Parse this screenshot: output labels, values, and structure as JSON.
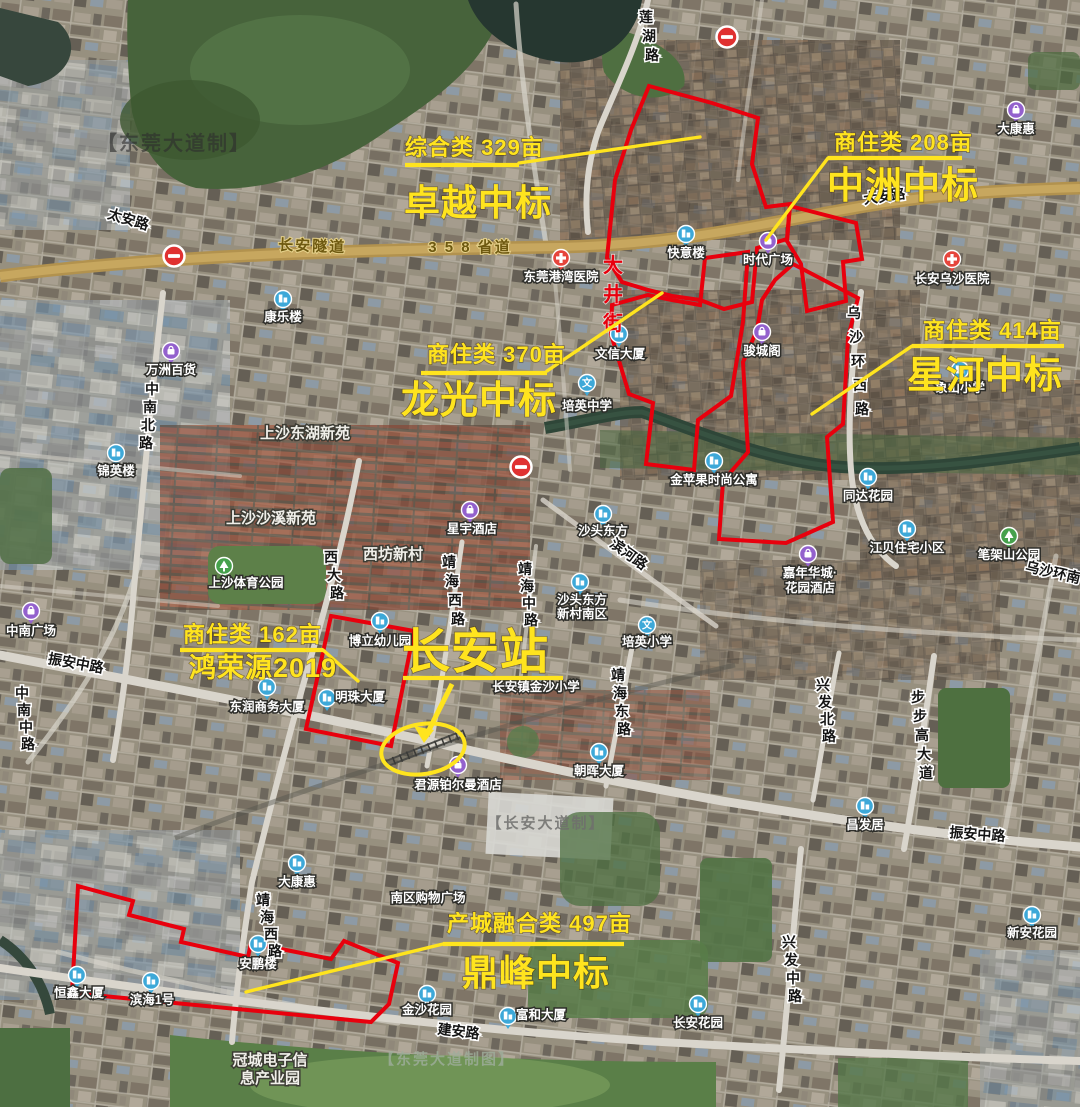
{
  "map": {
    "colors": {
      "annotation_yellow": "#ffe41e",
      "parcel_red": "#e8000d",
      "road_gold": "#b2924e"
    },
    "watermarks": [
      {
        "text": "【东莞大道制】",
        "x": 174,
        "y": 150,
        "size": 20,
        "fill": "#2e2e2e",
        "op": 0.62
      },
      {
        "text": "【长安大道制】",
        "x": 546,
        "y": 828,
        "size": 15,
        "fill": "#6f6f6d",
        "op": 0.85
      },
      {
        "text": "【东莞大道制图】",
        "x": 447,
        "y": 1064,
        "size": 15,
        "fill": "#9fae9c",
        "op": 0.8
      }
    ],
    "annotations": [
      {
        "id": "zhuoyue",
        "line1": "综合类 329亩",
        "line2": "卓越中标",
        "x1": 405,
        "y1": 155,
        "s1": 22,
        "x2": 404,
        "y2": 215,
        "s2": 36,
        "underline": [
          405,
          165,
          519,
          165
        ],
        "leader": "519,163 700,137"
      },
      {
        "id": "zhongzhou",
        "line1": "商住类 208亩",
        "line2": "中洲中标",
        "x1": 834,
        "y1": 150,
        "s1": 22,
        "x2": 827,
        "y2": 198,
        "s2": 37,
        "underline": [
          828,
          158,
          962,
          158
        ],
        "leader": "828,158 766,240"
      },
      {
        "id": "xinghe",
        "line1": "商住类 414亩",
        "line2": "星河中标",
        "x1": 923,
        "y1": 338,
        "s1": 22,
        "x2": 907,
        "y2": 388,
        "s2": 38,
        "underline": [
          912,
          346,
          1064,
          346
        ],
        "leader": "912,346 812,414"
      },
      {
        "id": "longguang",
        "line1": "商住类 370亩",
        "line2": "龙光中标",
        "x1": 427,
        "y1": 362,
        "s1": 22,
        "x2": 401,
        "y2": 413,
        "s2": 38,
        "underline": [
          421,
          373,
          547,
          373
        ],
        "leader": "547,371 662,293"
      },
      {
        "id": "hongrongyuan",
        "line1": "商住类 162亩",
        "line2": "鸿荣源2019",
        "x1": 183,
        "y1": 642,
        "s1": 22,
        "x2": 189,
        "y2": 677,
        "s2": 27,
        "underline": [
          180,
          650,
          323,
          650
        ],
        "leader": "323,650 358,681"
      },
      {
        "id": "dingfeng",
        "line1": "产城融合类 497亩",
        "line2": "鼎峰中标",
        "x1": 447,
        "y1": 931,
        "s1": 22,
        "x2": 462,
        "y2": 985,
        "s2": 36,
        "underline": [
          443,
          944,
          624,
          944
        ],
        "leader": "443,944 246,992"
      }
    ],
    "station": {
      "label": "长安站",
      "x": 402,
      "y": 668,
      "size": 48,
      "underline": [
        403,
        678,
        563,
        678
      ],
      "arrow_line": [
        452,
        684,
        427,
        734
      ],
      "arrow_head": "424,743 414,726 434,730",
      "ellipse": {
        "cx": 423,
        "cy": 749,
        "rx": 42,
        "ry": 25,
        "rot": -9
      }
    },
    "street_label": {
      "text": "大井街",
      "x": 613,
      "y": 272,
      "dy": 29
    },
    "parcels": [
      {
        "id": "zhuoyue",
        "points": "649,86 712,103 758,118 752,164 766,207 790,204 787,239 757,248 752,302 724,309 700,300 672,296 648,290 622,282 607,258 615,180 631,130"
      },
      {
        "id": "zhongzhou",
        "points": "790,206 856,223 862,259 843,262 846,301 807,311 801,264 787,241"
      },
      {
        "id": "longguang",
        "points": "612,305 648,295 672,300 700,305 705,258 748,252 743,322 731,396 698,420 694,470 646,464 653,403 629,394 611,334"
      },
      {
        "id": "xinghe",
        "points": "793,264 858,298 848,338 843,424 827,437 833,522 786,543 719,539 723,481 748,452 743,362 757,330 762,300 775,280"
      },
      {
        "id": "hongrongyuan",
        "points": "331,616 414,631 391,746 306,729"
      },
      {
        "id": "dingfeng",
        "points": "78,886 133,901 129,915 184,929 181,942 248,957 251,943 331,959 344,941 398,963 389,1004 371,1022 72,993"
      }
    ],
    "road_labels": [
      {
        "t": "太安路",
        "x": 127,
        "y": 224,
        "r": 17
      },
      {
        "t": "长安隧道",
        "x": 312,
        "y": 251,
        "r": 2,
        "g": 1
      },
      {
        "t": "3 5 8 省道",
        "x": 470,
        "y": 252,
        "r": 0,
        "g": 1
      },
      {
        "t": "大安路",
        "x": 885,
        "y": 201,
        "r": -8
      },
      {
        "t": "莲湖路",
        "x": 646,
        "y": 22,
        "v": 1,
        "dy": 19,
        "lean": 3
      },
      {
        "t": "中南北路",
        "x": 152,
        "y": 394,
        "v": 1,
        "dy": 18,
        "lean": -2
      },
      {
        "t": "中南中路",
        "x": 22,
        "y": 698,
        "v": 1,
        "dy": 17,
        "lean": 2
      },
      {
        "t": "振安中路",
        "x": 75,
        "y": 668,
        "r": 10
      },
      {
        "t": "西大路",
        "x": 331,
        "y": 562,
        "v": 1,
        "dy": 18,
        "lean": 3
      },
      {
        "t": "靖海西路",
        "x": 449,
        "y": 567,
        "v": 1,
        "dy": 19,
        "lean": 3
      },
      {
        "t": "靖海中路",
        "x": 525,
        "y": 574,
        "v": 1,
        "dy": 17,
        "lean": 2
      },
      {
        "t": "滨河路",
        "x": 626,
        "y": 558,
        "r": 36
      },
      {
        "t": "靖海东路",
        "x": 618,
        "y": 680,
        "v": 1,
        "dy": 18,
        "lean": 2
      },
      {
        "t": "兴发北路",
        "x": 823,
        "y": 690,
        "v": 1,
        "dy": 17,
        "lean": 2
      },
      {
        "t": "步步高大道",
        "x": 918,
        "y": 702,
        "v": 1,
        "dy": 19,
        "lean": 2
      },
      {
        "t": "振安中路",
        "x": 977,
        "y": 839,
        "r": 4
      },
      {
        "t": "兴发中路",
        "x": 789,
        "y": 947,
        "v": 1,
        "dy": 18,
        "lean": 2
      },
      {
        "t": "建安路",
        "x": 458,
        "y": 1036,
        "r": 7
      },
      {
        "t": "乌沙环西路",
        "x": 854,
        "y": 318,
        "v": 1,
        "dy": 24,
        "lean": 2
      },
      {
        "t": "乌沙环南",
        "x": 1052,
        "y": 577,
        "r": 13
      },
      {
        "t": "靖海西路",
        "x": 263,
        "y": 905,
        "v": 1,
        "dy": 17,
        "lean": 4
      }
    ],
    "place_labels": [
      {
        "t": "康乐楼",
        "x": 283,
        "y": 321,
        "i": {
          "k": "b",
          "x": 283,
          "y": 299
        }
      },
      {
        "t": "东莞港湾医院",
        "x": 561,
        "y": 281,
        "i": {
          "k": "h",
          "x": 561,
          "y": 258
        }
      },
      {
        "t": "万洲百货",
        "x": 171,
        "y": 374,
        "i": {
          "k": "p",
          "x": 171,
          "y": 351
        }
      },
      {
        "t": "锦英楼",
        "x": 116,
        "y": 475,
        "i": {
          "k": "b",
          "x": 116,
          "y": 453
        }
      },
      {
        "t": "上沙东湖新苑",
        "x": 305,
        "y": 438,
        "cls": "res"
      },
      {
        "t": "上沙沙溪新苑",
        "x": 271,
        "y": 523,
        "cls": "res"
      },
      {
        "t": "西坊新村",
        "x": 393,
        "y": 559,
        "cls": "res"
      },
      {
        "t": "上沙体育公园",
        "x": 246,
        "y": 587,
        "i": {
          "k": "g",
          "x": 224,
          "y": 566
        }
      },
      {
        "t": "星宇酒店",
        "x": 472,
        "y": 533,
        "i": {
          "k": "p",
          "x": 470,
          "y": 510
        }
      },
      {
        "t": "沙头东方",
        "x": 603,
        "y": 535,
        "i": {
          "k": "b",
          "x": 603,
          "y": 514
        }
      },
      {
        "t": "金苹果时尚公寓",
        "x": 714,
        "y": 484,
        "i": {
          "k": "b",
          "x": 714,
          "y": 461
        }
      },
      {
        "t": "同达花园",
        "x": 868,
        "y": 500,
        "i": {
          "k": "b",
          "x": 868,
          "y": 477
        }
      },
      {
        "t": "江贝住宅小区",
        "x": 907,
        "y": 552,
        "i": {
          "k": "b",
          "x": 907,
          "y": 529
        }
      },
      {
        "t": "笔架山公园",
        "x": 1009,
        "y": 559,
        "i": {
          "k": "g",
          "x": 1009,
          "y": 536
        }
      },
      {
        "lines": [
          "嘉年华城·",
          "花园酒店"
        ],
        "x": 810,
        "y": 577,
        "lh": 15,
        "i": {
          "k": "p",
          "x": 808,
          "y": 554
        }
      },
      {
        "lines": [
          "沙头东方",
          "新村南区"
        ],
        "x": 582,
        "y": 604,
        "lh": 14,
        "i": {
          "k": "b",
          "x": 580,
          "y": 582
        }
      },
      {
        "t": "培英中学",
        "x": 587,
        "y": 410,
        "i": {
          "k": "s",
          "x": 587,
          "y": 383
        }
      },
      {
        "t": "培英小学",
        "x": 647,
        "y": 646,
        "i": {
          "k": "s",
          "x": 647,
          "y": 625
        }
      },
      {
        "t": "文信大厦",
        "x": 620,
        "y": 358,
        "i": {
          "k": "b",
          "x": 619,
          "y": 334
        }
      },
      {
        "t": "快意楼",
        "x": 686,
        "y": 257,
        "i": {
          "k": "b",
          "x": 686,
          "y": 234
        }
      },
      {
        "t": "时代广场",
        "x": 768,
        "y": 264,
        "i": {
          "k": "p",
          "x": 768,
          "y": 241
        }
      },
      {
        "t": "骏城阁",
        "x": 762,
        "y": 355,
        "i": {
          "k": "p",
          "x": 762,
          "y": 332
        }
      },
      {
        "t": "象山小学",
        "x": 960,
        "y": 392,
        "i": {
          "k": "b",
          "x": 960,
          "y": 370
        }
      },
      {
        "t": "长安乌沙医院",
        "x": 952,
        "y": 283,
        "i": {
          "k": "h",
          "x": 952,
          "y": 259
        }
      },
      {
        "t": "大康惠",
        "x": 1016,
        "y": 133,
        "i": {
          "k": "p",
          "x": 1016,
          "y": 110
        }
      },
      {
        "t": "博立幼儿园",
        "x": 380,
        "y": 645,
        "i": {
          "k": "b",
          "x": 380,
          "y": 621
        }
      },
      {
        "t": "明珠大厦",
        "x": 360,
        "y": 701,
        "i": {
          "k": "b",
          "x": 327,
          "y": 698
        }
      },
      {
        "t": "东润商务大厦",
        "x": 267,
        "y": 711,
        "i": {
          "k": "b",
          "x": 267,
          "y": 687
        }
      },
      {
        "t": "中南广场",
        "x": 31,
        "y": 635,
        "i": {
          "k": "p",
          "x": 31,
          "y": 611
        }
      },
      {
        "t": "长安镇金沙小学",
        "x": 536,
        "y": 691
      },
      {
        "t": "君源铂尔曼酒店",
        "x": 458,
        "y": 789,
        "i": {
          "k": "p",
          "x": 458,
          "y": 765
        }
      },
      {
        "t": "朝晖大厦",
        "x": 599,
        "y": 775,
        "i": {
          "k": "b",
          "x": 599,
          "y": 752
        }
      },
      {
        "t": "昌发居",
        "x": 865,
        "y": 829,
        "i": {
          "k": "b",
          "x": 865,
          "y": 806
        }
      },
      {
        "t": "大康惠",
        "x": 297,
        "y": 886,
        "i": {
          "k": "b",
          "x": 297,
          "y": 863
        }
      },
      {
        "t": "南区购物广场",
        "x": 428,
        "y": 902
      },
      {
        "t": "安鹏楼",
        "x": 258,
        "y": 968,
        "i": {
          "k": "b",
          "x": 258,
          "y": 944
        }
      },
      {
        "t": "恒鑫大厦",
        "x": 79,
        "y": 997,
        "i": {
          "k": "b",
          "x": 77,
          "y": 975
        }
      },
      {
        "t": "滨海1号",
        "x": 152,
        "y": 1004,
        "i": {
          "k": "b",
          "x": 151,
          "y": 981
        }
      },
      {
        "t": "金沙花园",
        "x": 427,
        "y": 1014,
        "i": {
          "k": "b",
          "x": 427,
          "y": 994
        }
      },
      {
        "t": "富和大厦",
        "x": 541,
        "y": 1019,
        "i": {
          "k": "b",
          "x": 508,
          "y": 1016
        }
      },
      {
        "t": "长安花园",
        "x": 698,
        "y": 1027,
        "i": {
          "k": "b",
          "x": 698,
          "y": 1004
        }
      },
      {
        "t": "新安花园",
        "x": 1032,
        "y": 937,
        "i": {
          "k": "b",
          "x": 1032,
          "y": 915
        }
      },
      {
        "lines": [
          "冠城电子信",
          "息产业园"
        ],
        "x": 270,
        "y": 1065,
        "lh": 18,
        "cls": "res"
      }
    ],
    "signs": [
      {
        "x": 727,
        "y": 37
      },
      {
        "x": 174,
        "y": 256
      },
      {
        "x": 521,
        "y": 467
      }
    ]
  }
}
